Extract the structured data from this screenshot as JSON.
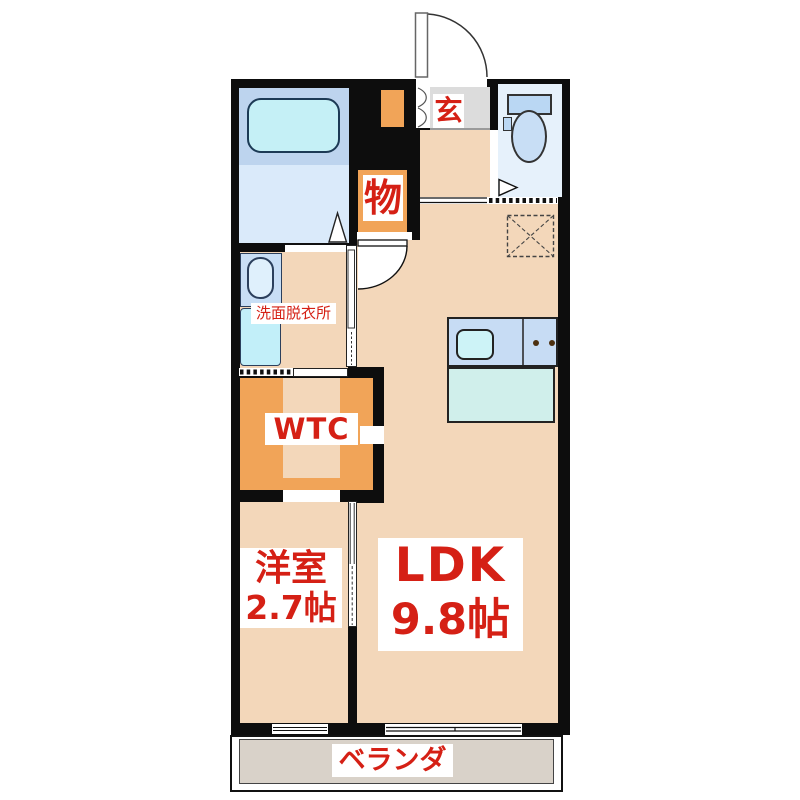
{
  "floorplan": {
    "type": "apartment-floor-plan",
    "labels": {
      "entrance": "玄",
      "storage": "物",
      "washroom": "洗面脱衣所",
      "walk_through_closet": "WTC",
      "bedroom_name": "洋室",
      "bedroom_size": "2.7帖",
      "living_name": "LDK",
      "living_size": "9.8帖",
      "veranda": "ベランダ"
    },
    "colors": {
      "wall": "#0d0d0d",
      "floor_peach": "#f3d7ba",
      "closet_orange": "#f1a458",
      "entrance_gray": "#dcdcdc",
      "veranda_gray": "#d9d2c9",
      "bath_blue_upper": "#bdd4ee",
      "bath_blue_lower": "#daeafa",
      "bathtub_cyan": "#c5f0f6",
      "fixture_blue": "#c8def5",
      "kitchen_counter_blue": "#c7dcf4",
      "kitchen_teal": "#d0efeb",
      "label_red": "#d52015"
    }
  }
}
